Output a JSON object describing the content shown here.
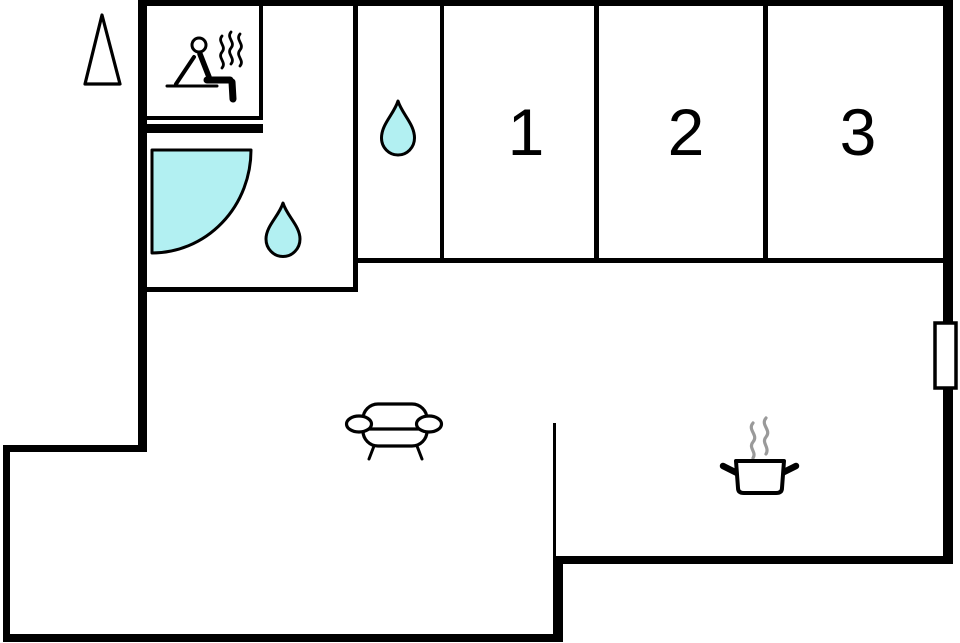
{
  "floorplan": {
    "background": "#ffffff",
    "wall_color": "#000000",
    "water_color": "#b2f0f2",
    "steam_color": "#9a9a9a",
    "bedrooms": [
      {
        "label": "1"
      },
      {
        "label": "2"
      },
      {
        "label": "3"
      }
    ],
    "icons": {
      "sauna": "sauna-person-icon",
      "sauna_heat": "heat-waves-icon",
      "shower": "shower-tray-icon",
      "bathroom_water": "water-drop-icon",
      "washroom_water": "water-drop-icon",
      "living": "sofa-icon",
      "kitchen": "cooking-pot-icon",
      "kitchen_steam": "steam-icon",
      "outside": "tree-icon",
      "window": "window-marker"
    }
  }
}
